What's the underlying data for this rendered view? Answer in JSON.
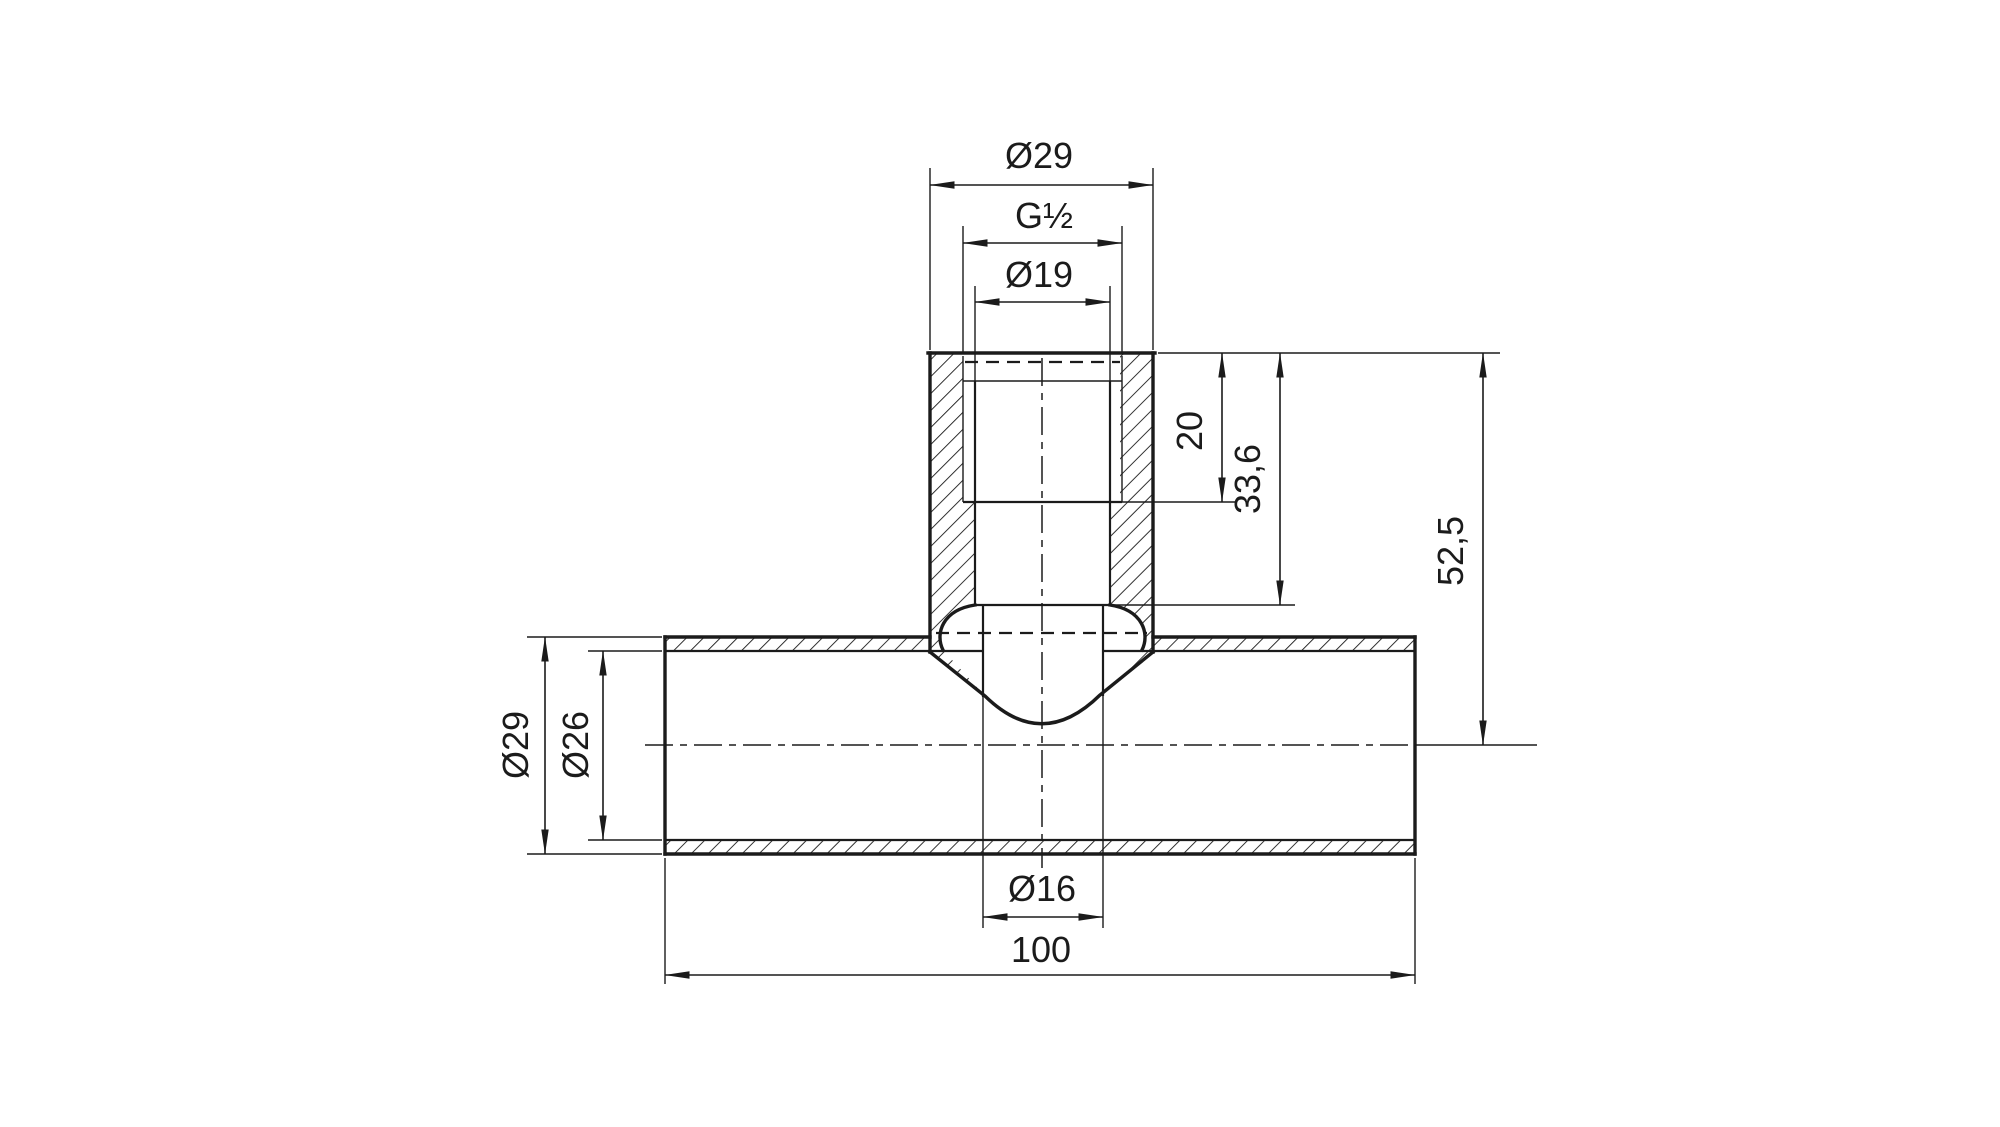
{
  "drawing": {
    "type": "technical-section-drawing",
    "subject": "tee-fitting-with-threaded-branch",
    "colors": {
      "line": "#1b1b1b",
      "background": "#ffffff"
    },
    "dimensions": {
      "branch_outer_diameter": "Ø29",
      "thread_size": "G½",
      "thread_bore_diameter": "Ø19",
      "thread_depth": "20",
      "bore_depth": "33,6",
      "branch_top_to_pipe_axis": "52,5",
      "pipe_outer_diameter": "Ø29",
      "pipe_inner_diameter": "Ø26",
      "branch_through_hole_diameter": "Ø16",
      "overall_length": "100"
    }
  }
}
